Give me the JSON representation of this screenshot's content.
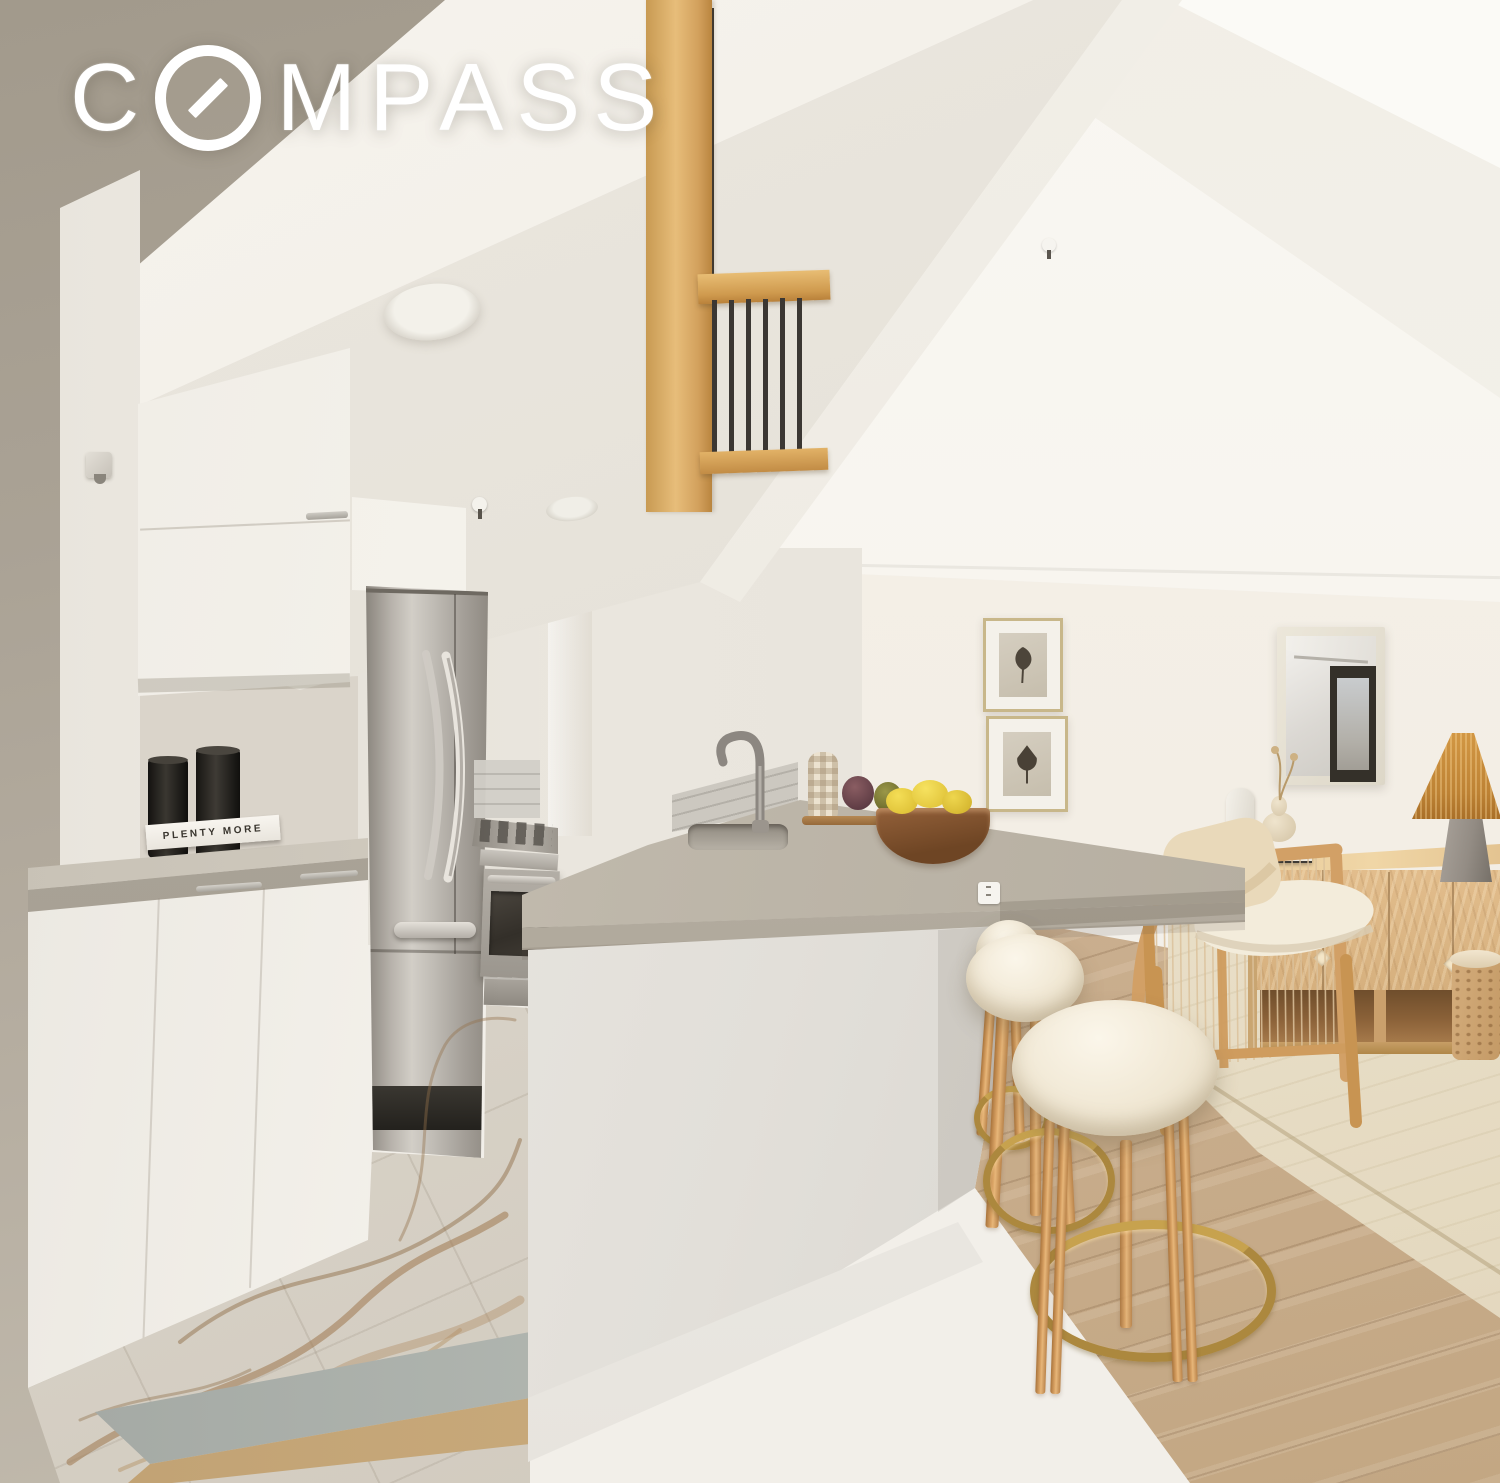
{
  "watermark": {
    "brand": "COMPASS",
    "part1": "C",
    "part2": "MPASS"
  },
  "kitchen": {
    "cookbook_title": "PLENTY MORE"
  },
  "scene": {
    "type": "real-estate listing photograph",
    "room": "open-plan loft kitchen with breakfast bar and living area",
    "palette": {
      "wall_white": "#f7f4ef",
      "wall_taupe": "#a89f92",
      "countertop_gray": "#b5ada0",
      "cabinet_white": "#f2efe9",
      "stainless": "#b4afa8",
      "oak_wood": "#d2a066",
      "floor_wood": "#cdb397",
      "marble": "#dcd6cb",
      "rug_cream": "#ebe2cd",
      "brass": "#ac883e",
      "rattan": "#c78f3e"
    },
    "objects": [
      "compass-watermark",
      "loft-railing",
      "soffit-beam",
      "ceiling-lights",
      "sprinkler-heads",
      "upper-cabinets",
      "wall-hook",
      "black-candleholders",
      "cookbook",
      "niche-countertop",
      "base-cabinets",
      "refrigerator",
      "gas-range",
      "subway-tile-backsplash",
      "marble-tile-floor",
      "threshold-strip",
      "peninsula-countertop",
      "undermount-sink",
      "gooseneck-faucet",
      "checkered-vase",
      "decorative-artichokes",
      "wood-tray",
      "fruit-bowl-with-lemons",
      "power-outlets",
      "bar-stools-with-brass-footrests",
      "wide-plank-wood-floor",
      "area-rug",
      "framed-leaf-prints",
      "wall-mirror",
      "rattan-table-lamp",
      "oak-credenza",
      "burl-side-table",
      "cane-accent-chair",
      "torso-sculpture",
      "gourd-vase",
      "stacked-books",
      "throw-pillow"
    ]
  }
}
